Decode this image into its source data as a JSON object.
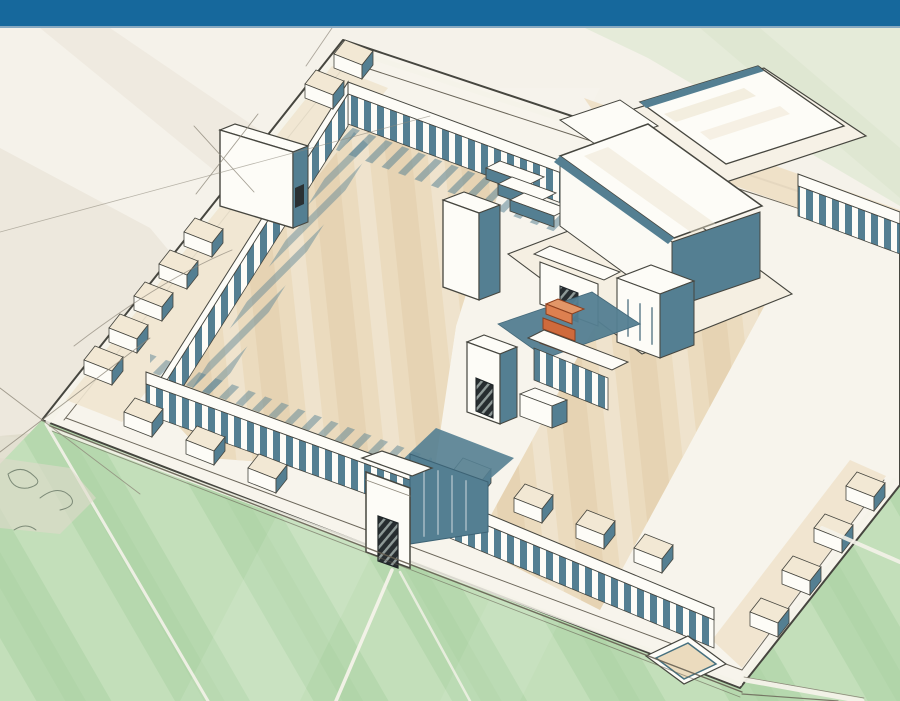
{
  "palette": {
    "header_blue": "#16689c",
    "header_blue_edge": "#87a9c1",
    "paper": "#f5f2ea",
    "wash_green": "#e4ead8",
    "wash_gray": "#e9e4d8",
    "lawn": "#b6d8ae",
    "lawn_light": "#cde5c5",
    "enclosure_cream": "#f7f4ec",
    "court_beige": "#ebdbbe",
    "court_beige_light": "#f2e8d4",
    "court_beige_dark": "#e0cba6",
    "wall_white": "#fdfcf7",
    "teal_shadow": "#547f92",
    "teal_deep": "#3d6375",
    "ink": "#46463f",
    "pencil": "#8e887b",
    "road_line": "#665f52",
    "path_white": "#f4f2e9",
    "accent_orange": "#cf6a3c",
    "accent_orange_dark": "#8d3f1e",
    "door_dark": "#272d30"
  },
  "scene": {
    "type": "hand-drawn architectural reconstruction sketch, isometric aerial view",
    "subject": "walled temple complex with colonnaded enclosure, chapel rows, great court, central sanctuary, pylon and gate towers, surrounding lawns with radiating paths",
    "highlight": "small orange stepped altar at the center of the complex"
  }
}
